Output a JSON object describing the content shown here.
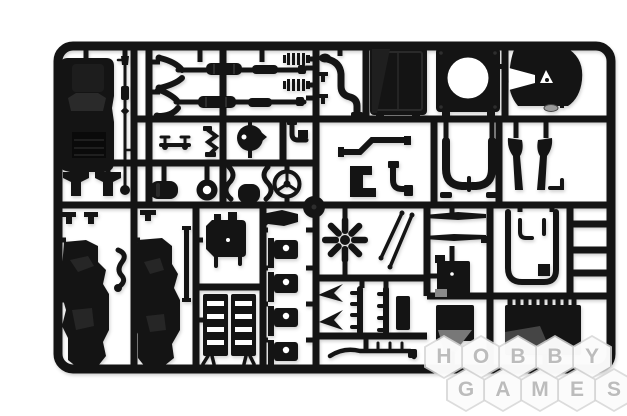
{
  "photo": {
    "subject": "Black plastic model-kit sprue frame with unassembled truck parts photographed on a white background",
    "background_color": "#ffffff",
    "plastic_color": "#141414",
    "highlight_color": "#2e2e2e"
  },
  "watermark": {
    "row1": [
      "H",
      "O",
      "B",
      "B",
      "Y"
    ],
    "row2": [
      "G",
      "A",
      "M",
      "E",
      "S"
    ],
    "letter_color": "#bcbcbc",
    "hex_fill": "#ffffff"
  },
  "parts": [
    "truck-cab-roof",
    "drive-shaft",
    "engine-mount-left",
    "engine-mount-right",
    "clip-row",
    "cab-side-panel-left",
    "cab-side-panel-right",
    "s-bracket",
    "side-strip",
    "exhaust-assembly-upper",
    "exhaust-assembly-lower",
    "coil-spring-top",
    "coil-spring-bottom",
    "bench-rack",
    "zigzag-bracket",
    "air-cleaner",
    "elbow-bracket",
    "muffler-small",
    "grommet-ring",
    "pipe-curve-left",
    "muffler-round",
    "pipe-curve-right",
    "steering-wheel",
    "wheel-hub-disc",
    "chassis-rail",
    "step-bracket",
    "hook-bracket",
    "radiator-hose",
    "hose-clamps",
    "radiator",
    "fan-shroud",
    "fifth-wheel-coupling",
    "kingpin",
    "rear-mudguard",
    "exhaust-stacks",
    "wiper-arm-upper",
    "wiper-arm-lower",
    "battery-box",
    "air-line-loop",
    "cooling-fan",
    "gear-levers",
    "wing-bracket-pair",
    "comb-rail-pair",
    "toothed-rail",
    "transmission",
    "engine-block-halves",
    "hinge-bracket-column",
    "storage-box",
    "ribbed-toolbox"
  ]
}
